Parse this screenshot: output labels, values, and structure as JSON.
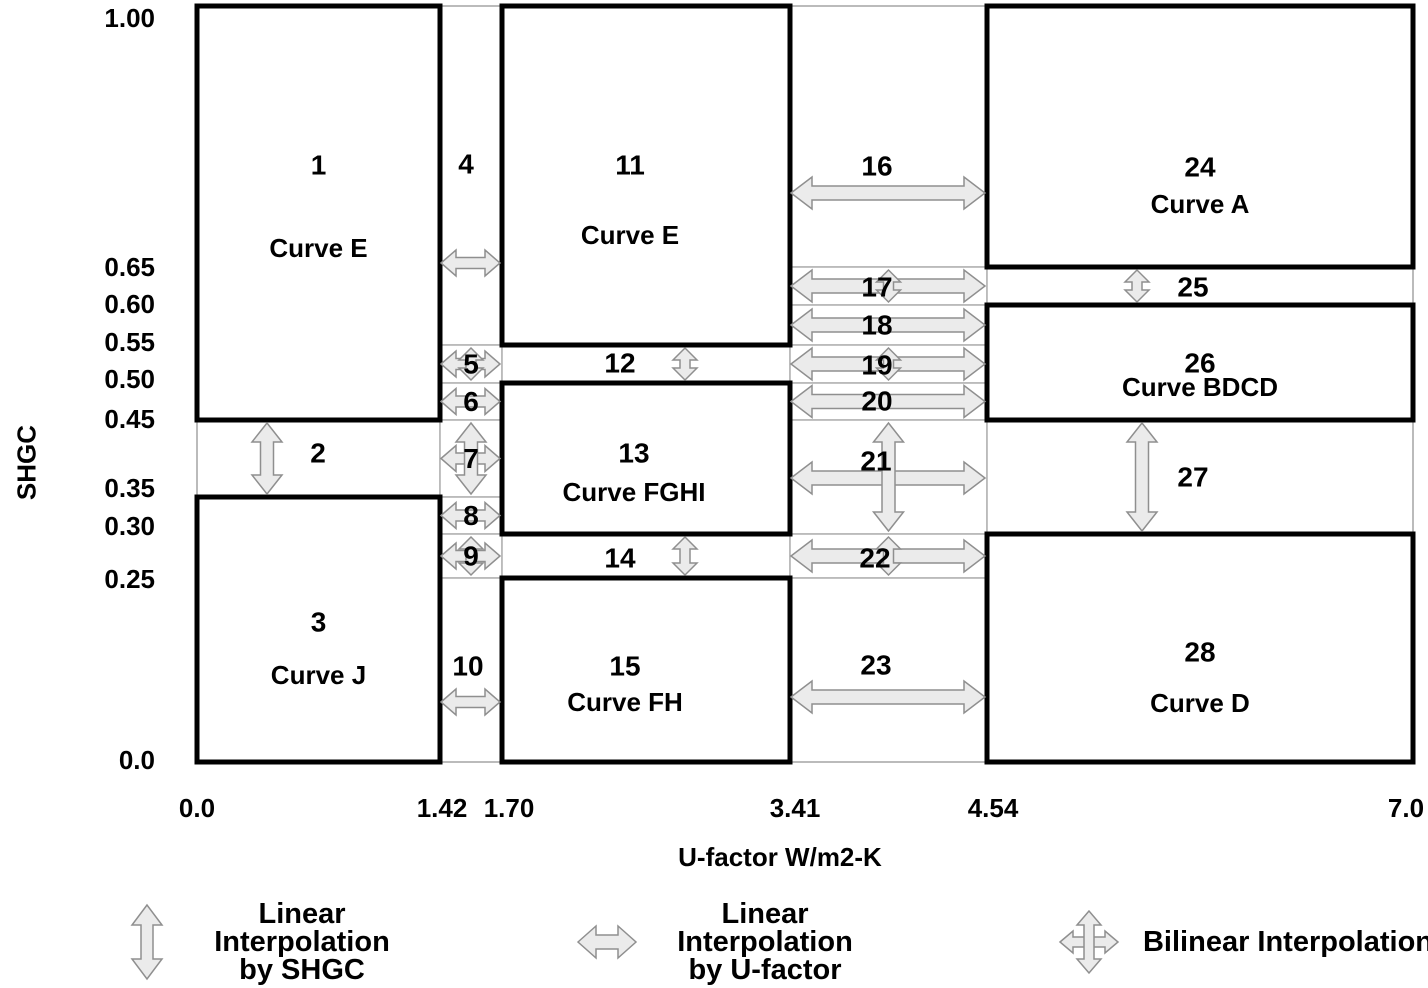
{
  "figure": {
    "y_axis_title": "SHGC",
    "x_axis_title": "U-factor W/m2-K",
    "y_ticks": [
      "1.00",
      "0.65",
      "0.60",
      "0.55",
      "0.50",
      "0.45",
      "0.35",
      "0.30",
      "0.25",
      "0.0"
    ],
    "x_ticks": [
      "0.0",
      "1.42",
      "1.70",
      "3.41",
      "4.54",
      "7.0"
    ]
  },
  "legend": {
    "items": [
      {
        "icon": "vertical-double-arrow-icon",
        "lines": [
          "Linear Interpolation",
          "by SHGC"
        ]
      },
      {
        "icon": "horizontal-double-arrow-icon",
        "lines": [
          "Linear Interpolation",
          "by U-factor"
        ]
      },
      {
        "icon": "four-way-arrow-icon",
        "lines": [
          "Bilinear Interpolation"
        ]
      }
    ]
  },
  "chart_data": {
    "type": "diagram",
    "title": "SHGC / U-factor interpolation regions",
    "x_axis": {
      "title": "U-factor W/m2-K",
      "ticks": [
        0.0,
        1.42,
        1.7,
        3.41,
        4.54,
        7.0
      ]
    },
    "y_axis": {
      "title": "SHGC",
      "ticks": [
        1.0,
        0.65,
        0.6,
        0.55,
        0.5,
        0.45,
        0.35,
        0.3,
        0.25,
        0.0
      ]
    },
    "interp_kinds": {
      "shgc": "Linear Interpolation by SHGC",
      "u": "Linear Interpolation by U-factor",
      "bilinear": "Bilinear Interpolation"
    },
    "regions": [
      {
        "id": "1",
        "label": "1",
        "curve": "Curve E",
        "kind": "box",
        "u": [
          0,
          1.42
        ],
        "shgc": [
          0.45,
          1.0
        ]
      },
      {
        "id": "2",
        "label": "2",
        "kind": "zone",
        "interp": "shgc",
        "u": [
          0,
          1.42
        ],
        "shgc": [
          0.35,
          0.45
        ]
      },
      {
        "id": "3",
        "label": "3",
        "curve": "Curve J",
        "kind": "box",
        "u": [
          0,
          1.42
        ],
        "shgc": [
          0,
          0.35
        ]
      },
      {
        "id": "4",
        "label": "4",
        "kind": "zone",
        "interp": "u",
        "u": [
          1.42,
          1.7
        ],
        "shgc": [
          0.55,
          1.0
        ]
      },
      {
        "id": "5",
        "label": "5",
        "kind": "zone",
        "interp": "bilinear",
        "u": [
          1.42,
          1.7
        ],
        "shgc": [
          0.5,
          0.55
        ]
      },
      {
        "id": "6",
        "label": "6",
        "kind": "zone",
        "interp": "u",
        "u": [
          1.42,
          1.7
        ],
        "shgc": [
          0.45,
          0.5
        ]
      },
      {
        "id": "7",
        "label": "7",
        "kind": "zone",
        "interp": "bilinear",
        "u": [
          1.42,
          1.7
        ],
        "shgc": [
          0.35,
          0.45
        ]
      },
      {
        "id": "8",
        "label": "8",
        "kind": "zone",
        "interp": "u",
        "u": [
          1.42,
          1.7
        ],
        "shgc": [
          0.3,
          0.35
        ]
      },
      {
        "id": "9",
        "label": "9",
        "kind": "zone",
        "interp": "bilinear",
        "u": [
          1.42,
          1.7
        ],
        "shgc": [
          0.25,
          0.3
        ]
      },
      {
        "id": "10",
        "label": "10",
        "kind": "zone",
        "interp": "u",
        "u": [
          1.42,
          1.7
        ],
        "shgc": [
          0,
          0.25
        ]
      },
      {
        "id": "11",
        "label": "11",
        "curve": "Curve E",
        "kind": "box",
        "u": [
          1.7,
          3.41
        ],
        "shgc": [
          0.55,
          1.0
        ]
      },
      {
        "id": "12",
        "label": "12",
        "kind": "zone",
        "interp": "shgc",
        "u": [
          1.7,
          3.41
        ],
        "shgc": [
          0.5,
          0.55
        ]
      },
      {
        "id": "13",
        "label": "13",
        "curve": "Curve FGHI",
        "kind": "box",
        "u": [
          1.7,
          3.41
        ],
        "shgc": [
          0.3,
          0.5
        ]
      },
      {
        "id": "14",
        "label": "14",
        "kind": "zone",
        "interp": "shgc",
        "u": [
          1.7,
          3.41
        ],
        "shgc": [
          0.25,
          0.3
        ]
      },
      {
        "id": "15",
        "label": "15",
        "curve": "Curve FH",
        "kind": "box",
        "u": [
          1.7,
          3.41
        ],
        "shgc": [
          0,
          0.25
        ]
      },
      {
        "id": "16",
        "label": "16",
        "kind": "zone",
        "interp": "u",
        "u": [
          3.41,
          4.54
        ],
        "shgc": [
          0.65,
          1.0
        ]
      },
      {
        "id": "17",
        "label": "17",
        "kind": "zone",
        "interp": "bilinear",
        "u": [
          3.41,
          4.54
        ],
        "shgc": [
          0.6,
          0.65
        ]
      },
      {
        "id": "18",
        "label": "18",
        "kind": "zone",
        "interp": "u",
        "u": [
          3.41,
          4.54
        ],
        "shgc": [
          0.55,
          0.6
        ]
      },
      {
        "id": "19",
        "label": "19",
        "kind": "zone",
        "interp": "bilinear",
        "u": [
          3.41,
          4.54
        ],
        "shgc": [
          0.5,
          0.55
        ]
      },
      {
        "id": "20",
        "label": "20",
        "kind": "zone",
        "interp": "u",
        "u": [
          3.41,
          4.54
        ],
        "shgc": [
          0.45,
          0.5
        ]
      },
      {
        "id": "21",
        "label": "21",
        "kind": "zone",
        "interp": "bilinear",
        "u": [
          3.41,
          4.54
        ],
        "shgc": [
          0.3,
          0.45
        ]
      },
      {
        "id": "22",
        "label": "22",
        "kind": "zone",
        "interp": "bilinear",
        "u": [
          3.41,
          4.54
        ],
        "shgc": [
          0.25,
          0.3
        ]
      },
      {
        "id": "23",
        "label": "23",
        "kind": "zone",
        "interp": "u",
        "u": [
          3.41,
          4.54
        ],
        "shgc": [
          0,
          0.25
        ]
      },
      {
        "id": "24",
        "label": "24",
        "curve": "Curve A",
        "kind": "box",
        "u": [
          4.54,
          7
        ],
        "shgc": [
          0.65,
          1.0
        ]
      },
      {
        "id": "25",
        "label": "25",
        "kind": "zone",
        "interp": "shgc",
        "u": [
          4.54,
          7
        ],
        "shgc": [
          0.6,
          0.65
        ]
      },
      {
        "id": "26",
        "label": "26",
        "curve": "Curve BDCD",
        "kind": "box",
        "u": [
          4.54,
          7
        ],
        "shgc": [
          0.45,
          0.6
        ]
      },
      {
        "id": "27",
        "label": "27",
        "kind": "zone",
        "interp": "shgc",
        "u": [
          4.54,
          7
        ],
        "shgc": [
          0.3,
          0.45
        ]
      },
      {
        "id": "28",
        "label": "28",
        "curve": "Curve D",
        "kind": "box",
        "u": [
          4.54,
          7
        ],
        "shgc": [
          0,
          0.3
        ]
      }
    ]
  }
}
